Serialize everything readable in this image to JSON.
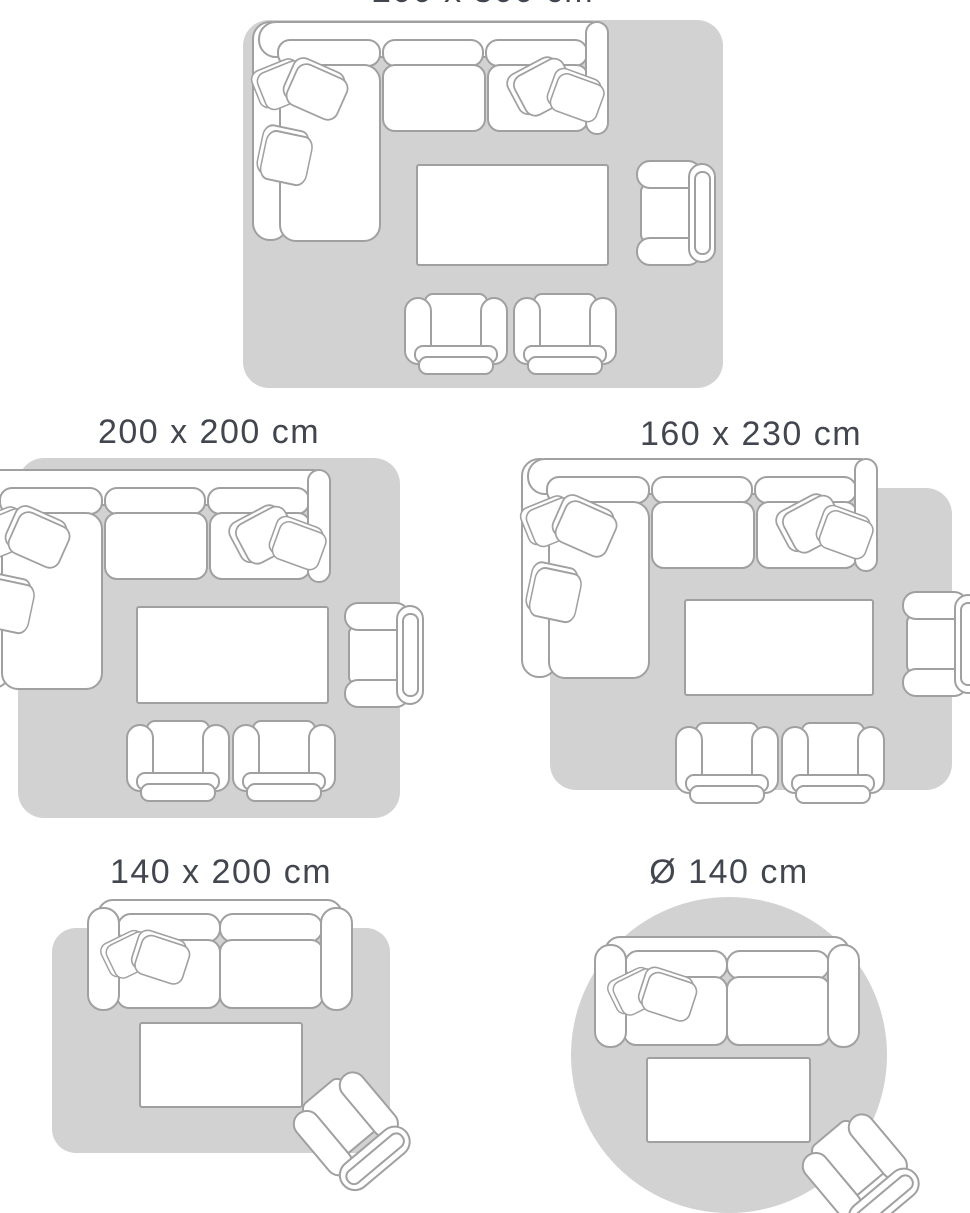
{
  "image_type": "rug-size-guide-illustration",
  "colors": {
    "rug": "#d2d2d2",
    "outline": "#a0a0a0",
    "furniture": "#ffffff",
    "label_text": "#42464e",
    "background": "#ffffff"
  },
  "panels": [
    {
      "id": "200x300",
      "label": "200 x 300 cm",
      "rug_shape": "rectangle",
      "label_cropped_at_top_edge": true,
      "furniture": [
        "corner-sofa-with-pillows",
        "coffee-table",
        "armchair",
        "footstool-chair",
        "footstool-chair"
      ]
    },
    {
      "id": "200x200",
      "label": "200 x 200 cm",
      "rug_shape": "rectangle",
      "furniture": [
        "corner-sofa-with-pillows",
        "coffee-table",
        "armchair",
        "footstool-chair",
        "footstool-chair"
      ]
    },
    {
      "id": "160x230",
      "label": "160 x 230 cm",
      "rug_shape": "rectangle",
      "furniture": [
        "corner-sofa-with-pillows",
        "coffee-table",
        "armchair",
        "footstool-chair",
        "footstool-chair"
      ]
    },
    {
      "id": "140x200",
      "label": "140 x 200 cm",
      "rug_shape": "rectangle",
      "furniture": [
        "two-seat-sofa-with-pillows",
        "coffee-table",
        "tilted-armchair"
      ]
    },
    {
      "id": "d140",
      "label": "Ø 140 cm",
      "rug_shape": "circle",
      "furniture": [
        "two-seat-sofa-with-pillows",
        "coffee-table",
        "tilted-armchair"
      ]
    }
  ]
}
